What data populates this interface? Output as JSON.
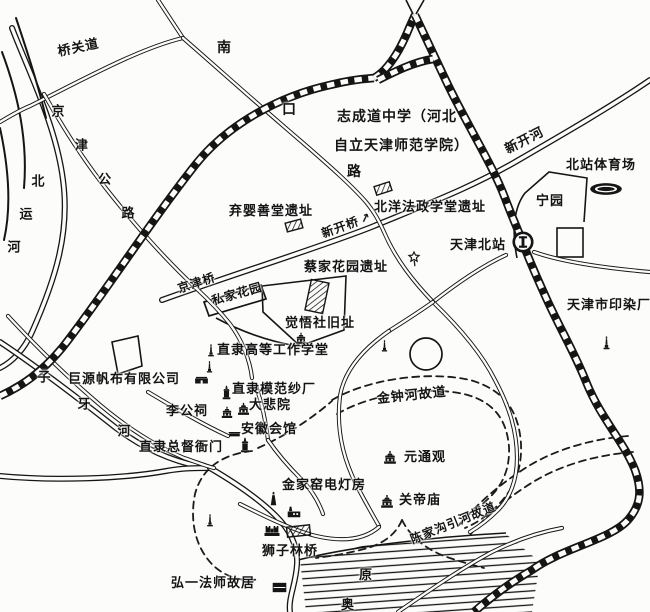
{
  "map": {
    "type": "hand-drawn historical city map (Tianjin, north station area)",
    "ink_color": "#151515",
    "paper_color": "#fcfcfb",
    "labels": [
      {
        "id": "qiaoguandao-road",
        "text": "桥关道",
        "x": 58,
        "y": 46,
        "rot": -12,
        "fs": 13
      },
      {
        "id": "nankou-road",
        "text": "南口路",
        "x1": 224,
        "y1": 48,
        "x2": 354,
        "y2": 172,
        "mode": "spread",
        "fs": 14
      },
      {
        "id": "jingjin-highway",
        "text": "京津公路",
        "x1": 58,
        "y1": 112,
        "x2": 128,
        "y2": 214,
        "mode": "spread",
        "fs": 13
      },
      {
        "id": "beiyun-river",
        "text": "北运河",
        "x1": 38,
        "y1": 182,
        "x2": 14,
        "y2": 248,
        "mode": "spread",
        "fs": 13
      },
      {
        "id": "ziya-river",
        "text": "子牙河",
        "x1": 44,
        "y1": 378,
        "x2": 124,
        "y2": 432,
        "mode": "spread",
        "fs": 13
      },
      {
        "id": "zhicheng-school-line1",
        "text": "志成道中学（河北",
        "x": 337,
        "y": 110,
        "fs": 14
      },
      {
        "id": "zhicheng-school-line2",
        "text": "自立天津师范学院）",
        "x": 334,
        "y": 139,
        "fs": 14
      },
      {
        "id": "xinkai-river",
        "text": "新开河",
        "x": 506,
        "y": 144,
        "rot": -27,
        "fs": 13
      },
      {
        "id": "north-station-stadium",
        "text": "北站体育场",
        "x": 566,
        "y": 159,
        "fs": 13
      },
      {
        "id": "ningyuan-park",
        "text": "宁园",
        "x": 536,
        "y": 195,
        "fs": 13
      },
      {
        "id": "tianjin-north-station",
        "text": "天津北站",
        "x": 450,
        "y": 239,
        "fs": 13
      },
      {
        "id": "tianjin-dyeing-factory",
        "text": "天津市印染厂",
        "x": 567,
        "y": 299,
        "fs": 13
      },
      {
        "id": "qiying-charity-site",
        "text": "弃婴善堂遗址",
        "x": 229,
        "y": 205,
        "fs": 13
      },
      {
        "id": "beiyang-law-school-site",
        "text": "北洋法政学堂遗址",
        "x": 374,
        "y": 201,
        "fs": 13
      },
      {
        "id": "xinkai-bridge",
        "text": "新开桥",
        "x": 322,
        "y": 228,
        "rot": -20,
        "fs": 12,
        "arrow": "↗"
      },
      {
        "id": "jingjin-bridge",
        "text": "京津桥",
        "x": 178,
        "y": 283,
        "rot": -18,
        "fs": 12
      },
      {
        "id": "private-garden",
        "text": "私家花园",
        "x": 212,
        "y": 295,
        "rot": -16,
        "fs": 12
      },
      {
        "id": "caijia-garden-site",
        "text": "蔡家花园遗址",
        "x": 304,
        "y": 261,
        "fs": 13
      },
      {
        "id": "juewushe-site",
        "text": "觉悟社旧址",
        "x": 285,
        "y": 317,
        "fs": 13
      },
      {
        "id": "zhili-industrial-school",
        "text": "直隶高等工作学堂",
        "x": 217,
        "y": 344,
        "fs": 13
      },
      {
        "id": "juyuan-canvas-co",
        "text": "巨源帆布有限公司",
        "x": 68,
        "y": 373,
        "fs": 13
      },
      {
        "id": "zhili-model-mill",
        "text": "直隶模范纱厂",
        "x": 232,
        "y": 383,
        "fs": 13
      },
      {
        "id": "li-gong-ci",
        "text": "李公祠",
        "x": 166,
        "y": 405,
        "fs": 13
      },
      {
        "id": "dabeiyuan",
        "text": "大悲院",
        "x": 249,
        "y": 399,
        "fs": 13
      },
      {
        "id": "anhui-huiguan",
        "text": "安徽会馆",
        "x": 241,
        "y": 423,
        "fs": 13
      },
      {
        "id": "zhili-governor-yamen",
        "text": "直隶总督衙门",
        "x": 139,
        "y": 441,
        "fs": 13
      },
      {
        "id": "jinjiayao-power-house",
        "text": "金家窑电灯房",
        "x": 282,
        "y": 479,
        "fs": 13
      },
      {
        "id": "yuantongguan",
        "text": "元通观",
        "x": 404,
        "y": 451,
        "fs": 13
      },
      {
        "id": "guandimiao",
        "text": "关帝庙",
        "x": 399,
        "y": 494,
        "fs": 13
      },
      {
        "id": "jinzhong-old-course",
        "text": "金钟河故道",
        "x": 377,
        "y": 393,
        "rot": -6,
        "fs": 13
      },
      {
        "id": "chenjiagou-old-course",
        "text": "陈家沟引河故道",
        "x": 411,
        "y": 534,
        "rot": -22,
        "fs": 12
      },
      {
        "id": "shizilin-bridge",
        "text": "狮子林桥",
        "x": 262,
        "y": 545,
        "fs": 13
      },
      {
        "id": "hongyi-residence",
        "text": "弘一法师故居",
        "x": 171,
        "y": 577,
        "fs": 13
      },
      {
        "id": "yuan-char",
        "text": "原",
        "x": 359,
        "y": 569,
        "fs": 13
      },
      {
        "id": "ao-char",
        "text": "奥",
        "x": 341,
        "y": 599,
        "fs": 13
      }
    ],
    "places": [
      {
        "name": "qiying-site-marker",
        "type": "hatch",
        "x": 286,
        "y": 221,
        "w": 16,
        "h": 9,
        "rot": -15
      },
      {
        "name": "beiyang-law-site-marker",
        "type": "hatch",
        "x": 375,
        "y": 184,
        "w": 16,
        "h": 9,
        "rot": -18
      },
      {
        "name": "caijia-garden-site-marker",
        "type": "hatch",
        "x": 308,
        "y": 281,
        "w": 18,
        "h": 31,
        "rot": 12
      },
      {
        "name": "shizilin-bridge-marker",
        "type": "hatch",
        "x": 287,
        "y": 526,
        "w": 23,
        "h": 10,
        "rot": -6
      },
      {
        "name": "juewushe-icon",
        "type": "temple",
        "x": 293,
        "y": 330,
        "s": 16
      },
      {
        "name": "industrial-school-icon",
        "type": "monument",
        "x": 203,
        "y": 342,
        "s": 16
      },
      {
        "name": "monument-icon-2",
        "type": "monument",
        "x": 202,
        "y": 359,
        "s": 15
      },
      {
        "name": "juyuan-canvas-icon",
        "type": "building",
        "x": 193,
        "y": 369,
        "s": 17
      },
      {
        "name": "mofan-mill-icon",
        "type": "tower",
        "x": 218,
        "y": 384,
        "s": 17
      },
      {
        "name": "ligongci-icon",
        "type": "temple",
        "x": 219,
        "y": 404,
        "s": 16
      },
      {
        "name": "dabeiyuan-icon",
        "type": "temple",
        "x": 235,
        "y": 400,
        "s": 17
      },
      {
        "name": "anhui-huiguan-icon",
        "type": "house",
        "x": 227,
        "y": 424,
        "s": 15
      },
      {
        "name": "governor-yamen-icon",
        "type": "tower",
        "x": 236,
        "y": 436,
        "s": 18
      },
      {
        "name": "power-chimney-icon",
        "type": "chimney",
        "x": 265,
        "y": 490,
        "s": 17
      },
      {
        "name": "power-plant-icon",
        "type": "factory",
        "x": 285,
        "y": 502,
        "s": 18
      },
      {
        "name": "wanghailou-castle-icon",
        "type": "castle",
        "x": 262,
        "y": 518,
        "s": 20
      },
      {
        "name": "monument-icon-3",
        "type": "monument",
        "x": 202,
        "y": 512,
        "s": 16
      },
      {
        "name": "yuantongguan-icon",
        "type": "temple",
        "x": 381,
        "y": 448,
        "s": 18
      },
      {
        "name": "guandimiao-icon",
        "type": "temple",
        "x": 378,
        "y": 492,
        "s": 18
      },
      {
        "name": "hongyi-residence-icon",
        "type": "blacksq",
        "x": 271,
        "y": 579,
        "s": 17
      },
      {
        "name": "dyeing-factory-icon",
        "type": "monument",
        "x": 598,
        "y": 334,
        "s": 17
      },
      {
        "name": "monument-icon-4",
        "type": "monument",
        "x": 377,
        "y": 338,
        "s": 15
      },
      {
        "name": "star-marker-icon",
        "type": "star",
        "x": 405,
        "y": 250,
        "s": 18
      },
      {
        "name": "stadium-icon",
        "type": "stadium",
        "x": 589,
        "y": 180,
        "w": 34,
        "h": 18
      },
      {
        "name": "station-icon",
        "type": "station",
        "x": 512,
        "y": 231,
        "s": 22
      }
    ]
  }
}
